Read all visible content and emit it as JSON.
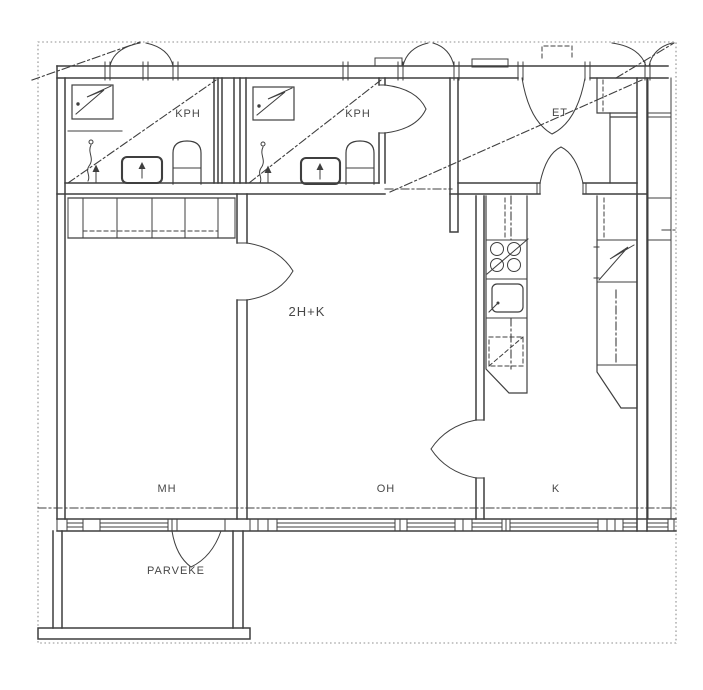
{
  "plan": {
    "apartment_type_label": "2H+K",
    "rooms": {
      "kph_left": "KPH",
      "kph_right": "KPH",
      "et": "ET",
      "mh": "MH",
      "oh": "OH",
      "k": "K",
      "parveke": "PARVEKE"
    },
    "colors": {
      "line": "#3f3f3f",
      "page_border": "#8f8f8f",
      "text": "#474747",
      "background": "#ffffff"
    }
  }
}
